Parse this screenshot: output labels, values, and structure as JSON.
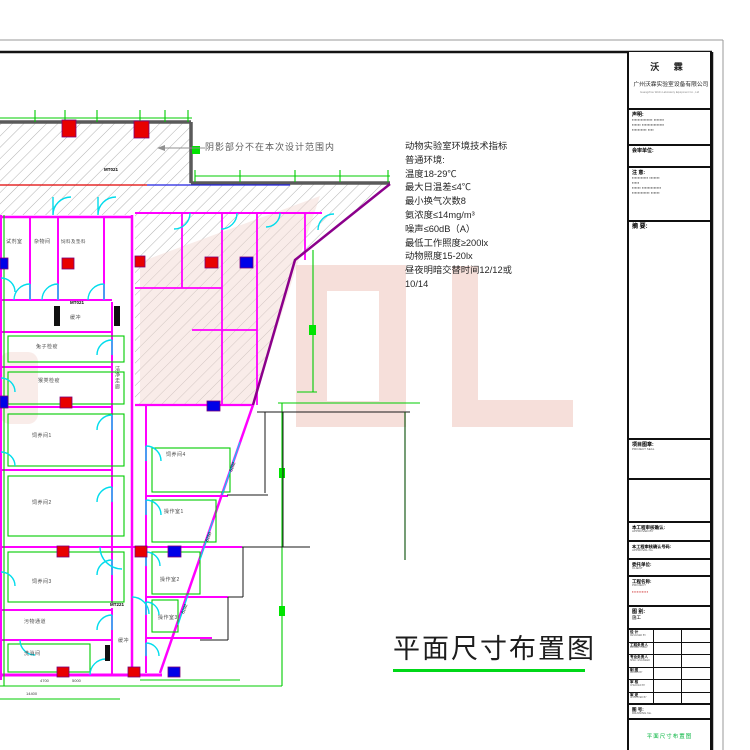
{
  "sheet": {
    "note": "阴影部分不在本次设计范围内",
    "drawing_title": "平面尺寸布置图",
    "spec_title": "动物实验室环境技术指标",
    "spec_lines": [
      "普通环境:",
      "温度18-29℃",
      "最大日温差≤4℃",
      "最小换气次数8",
      "氨浓度≤14mg/m³",
      "噪声≤60dB（A）",
      "最低工作照度≥200lx",
      "动物照度15-20lx",
      "昼夜明暗交替时间12/12或",
      "10/14"
    ]
  },
  "plan": {
    "rooms": [
      "试剂室",
      "杂物间",
      "饲料及垫料",
      "缓冲",
      "兔子检疫",
      "猴类检疫",
      "饲养间1",
      "饲养间2",
      "饲养间3",
      "污物通道",
      "洗消间",
      "洁净走廊",
      "饲养间4",
      "操作室1",
      "操作室2",
      "操作室3",
      "缓冲"
    ],
    "tags": {
      "mt021a": "MT021",
      "mt021b": "MT021",
      "mt221": "MT221"
    },
    "dims": {
      "d1": "4700",
      "d2": "5000",
      "d3": "14400",
      "diag1": "6292",
      "diag2": "6250",
      "diag3": "6292"
    }
  },
  "titleblock": {
    "logo": "沃 霖",
    "company_cn": "广州沃霖实验室设备有限公司",
    "company_en": "Guangzhou Wolin Laboratory Equipment Co., Ltd",
    "statement_label": "声明:",
    "statement_l1": "▪▪▪▪▪▪▪▪▪▪▪▪▪▪ ▪▪▪▪▪▪▪",
    "statement_l2": "▪▪▪▪▪▪ ▪▪▪▪▪▪▪▪▪▪▪▪▪▪▪",
    "statement_l3": "▪▪▪▪▪▪▪▪▪▪ ▪▪▪▪",
    "review_label": "会审单位:",
    "notice_label": "注 意:",
    "notice_l1": "▪▪▪▪▪▪▪▪▪▪▪ ▪▪▪▪▪▪▪",
    "notice_l2": "▪▪▪▪▪",
    "notice_l3": "▪▪▪▪▪▪ ▪▪▪▪▪▪▪▪▪▪▪▪▪",
    "notice_l4": "▪▪▪▪▪▪▪▪▪▪▪▪ ▪▪▪▪▪▪",
    "abstract_label": "摘 要:",
    "seal_label": "项目图章:",
    "seal_sub": "PROJECT SEAL",
    "approved_label": "本工程审核确认:",
    "approved_sub": "APPROVED BY",
    "approval_no_label": "本工程审核确认号码:",
    "approval_no_sub": "APPROVAL No.",
    "client_label": "委托单位:",
    "client_sub": "CLIENT",
    "project_label": "工程名称:",
    "project_sub": "PROJECT",
    "project_value": "▪▪▪▪▪▪▪▪▪▪",
    "category_label": "图 别:",
    "category_value": "施工",
    "sign_rows": [
      {
        "cn": "设 计",
        "en": "DESIGNED BY"
      },
      {
        "cn": "工程负责人",
        "en": "PROJECT MGR."
      },
      {
        "cn": "专业负责人",
        "en": "SPEC. ENGINEER"
      },
      {
        "cn": "制 图",
        "en": "DRAWN BY"
      },
      {
        "cn": "审 核",
        "en": "CHECKED BY"
      },
      {
        "cn": "审 定",
        "en": "APPROVED BY"
      }
    ],
    "number_label": "图 号:",
    "number_sub": "DRAWING No.",
    "drawing_name_green": "平面尺寸布置图"
  }
}
